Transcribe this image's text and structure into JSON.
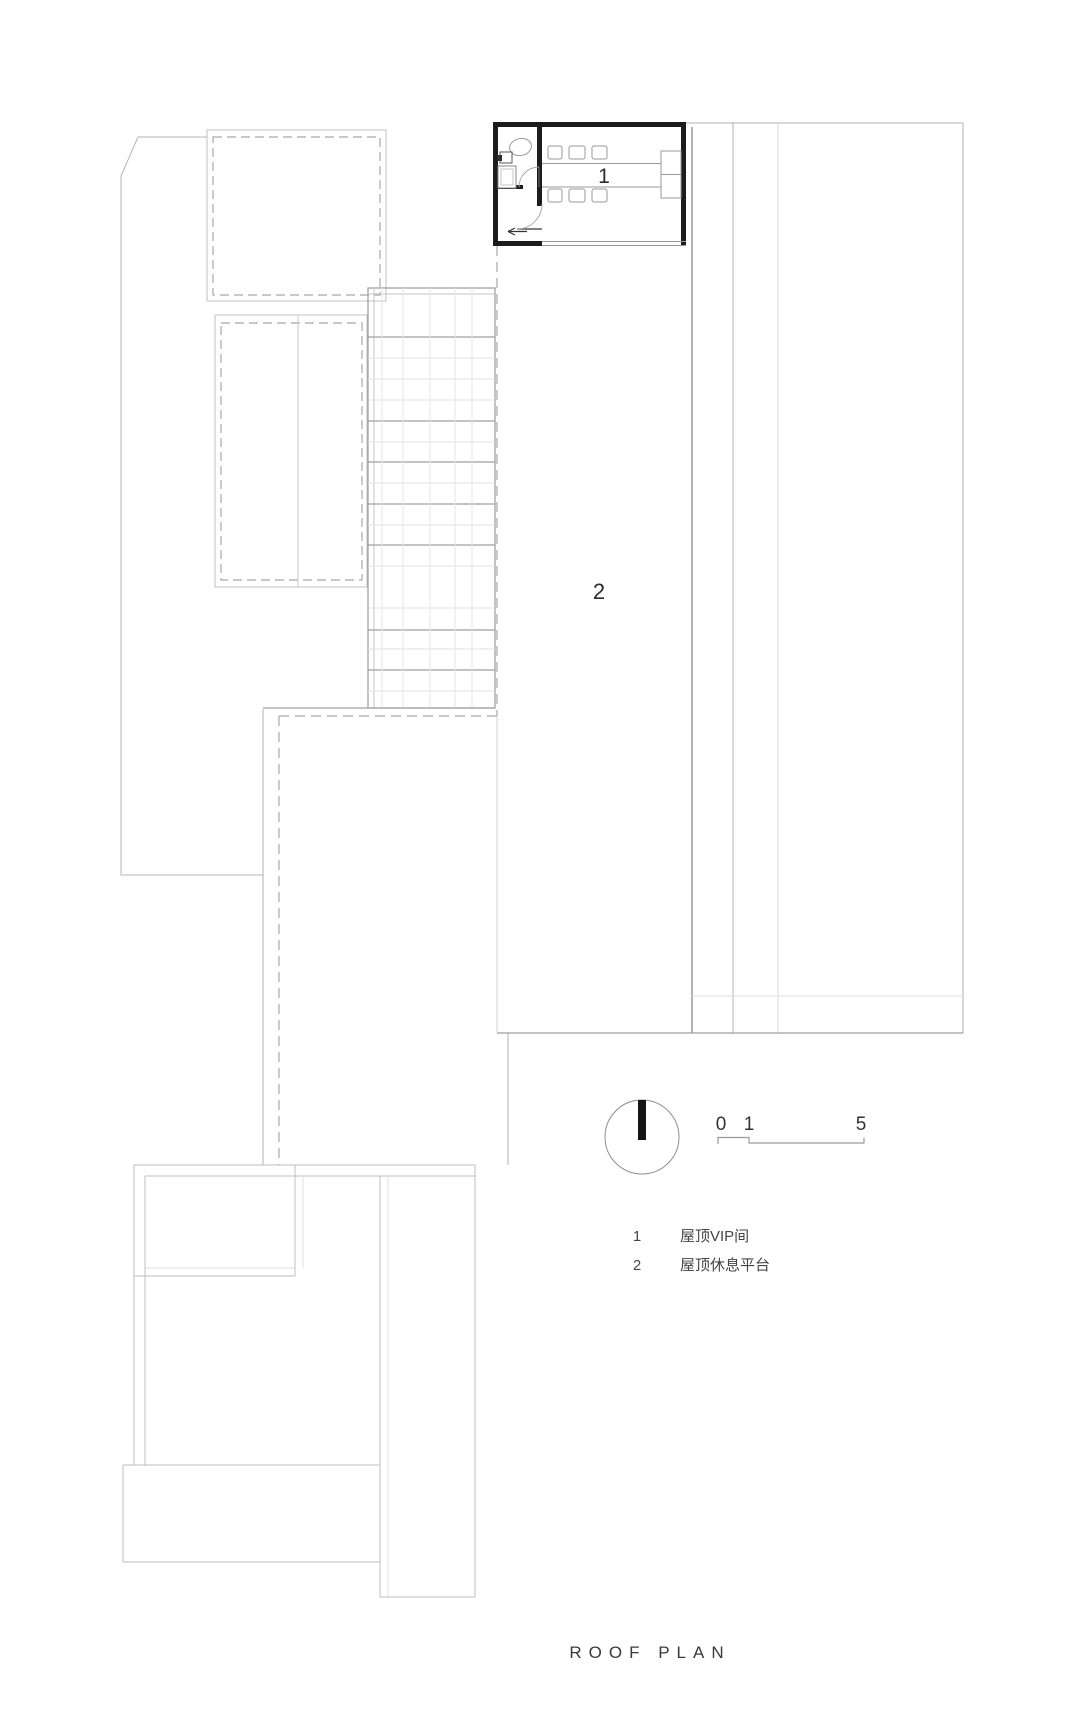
{
  "title": "ROOF PLAN",
  "plan_labels": {
    "vip_room": "1",
    "terrace": "2"
  },
  "scale_bar": {
    "ticks": [
      "0",
      "1",
      "5"
    ]
  },
  "legend": [
    {
      "num": "1",
      "label": "屋顶VIP间"
    },
    {
      "num": "2",
      "label": "屋顶休息平台"
    }
  ],
  "colors": {
    "wall": "#1c1c1c",
    "line_light": "#b5b5b5",
    "line_medium": "#8f8f8f",
    "dashed": "#a8a8a8",
    "background": "#ffffff"
  }
}
